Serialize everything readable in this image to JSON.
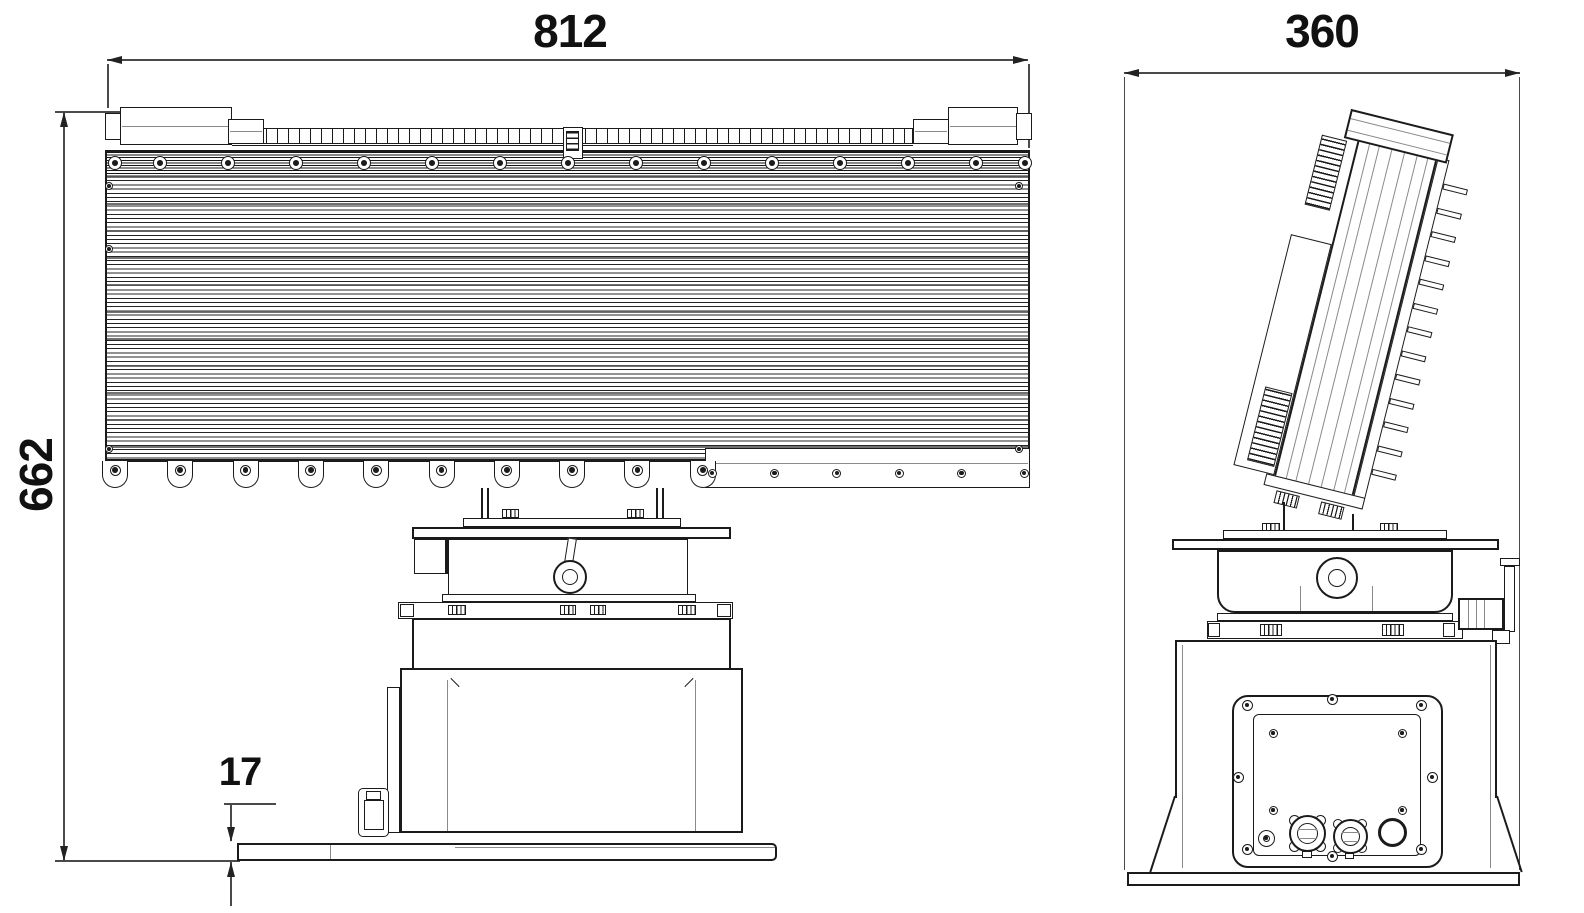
{
  "drawing": {
    "background_color": "#ffffff",
    "line_color": "#1b1b1b",
    "dimension_line_color": "#4a4a4a",
    "dimensions": {
      "front_width": "812",
      "front_height": "662",
      "base_plate_thickness": "17",
      "side_depth": "360"
    },
    "repeat_counts": {
      "front_top_bolts": 15,
      "front_bottom_tabs": 10,
      "front_bottom_dots": 6,
      "side_fins": 13,
      "connector_frame_bolts": 8,
      "connector_plate_screws": 4
    }
  }
}
